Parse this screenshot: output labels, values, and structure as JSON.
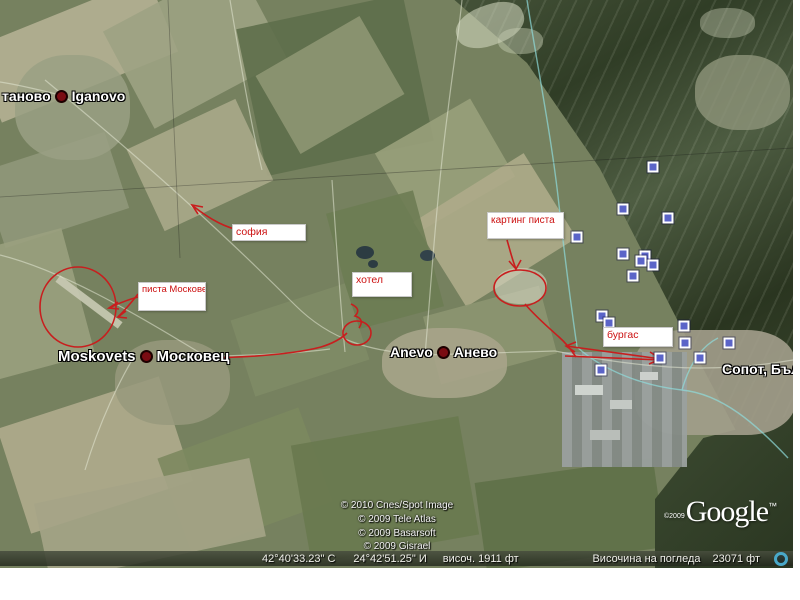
{
  "towns": [
    {
      "pre": "таново",
      "post": "Iganovo"
    },
    {
      "pre": "Moskovets",
      "post": "Московец"
    },
    {
      "pre": "Anevo",
      "post": "Анево"
    },
    {
      "pre": "Сопот, Бъл",
      "post": ""
    }
  ],
  "annotations": {
    "sofia": "софия",
    "pista_moskovets": "писта Московец",
    "hotel": "хотел",
    "karting": "картинг писта",
    "burgas": "бургас"
  },
  "copyright_lines": [
    "© 2010 Cnes/Spot Image",
    "© 2009 Tele Atlas",
    "© 2009 Basarsoft",
    "© 2009 Gisrael"
  ],
  "google": {
    "copyright": "©2009",
    "logo": "Google",
    "tm": "™"
  },
  "status_bar": {
    "latitude": "42°40'33.23\" С",
    "longitude": "24°42'51.25\" И",
    "elevation": "височ.  1911 фт",
    "eye_altitude_label": "Височина на погледа",
    "eye_altitude_value": "23071 фт"
  },
  "placemarks": [
    [
      653,
      167
    ],
    [
      623,
      209
    ],
    [
      668,
      218
    ],
    [
      577,
      237
    ],
    [
      623,
      254
    ],
    [
      645,
      256
    ],
    [
      641,
      261
    ],
    [
      653,
      265
    ],
    [
      633,
      276
    ],
    [
      602,
      316
    ],
    [
      609,
      323
    ],
    [
      684,
      326
    ],
    [
      685,
      343
    ],
    [
      660,
      358
    ],
    [
      601,
      370
    ],
    [
      729,
      343
    ],
    [
      700,
      358
    ]
  ],
  "colors": {
    "annotation_red": "#cc1111",
    "route_red": "#c81e1e",
    "placemark_blue": "#5b64c8",
    "town_dot_red": "#7a0c12",
    "road_cyan": "#8fdcdc"
  }
}
